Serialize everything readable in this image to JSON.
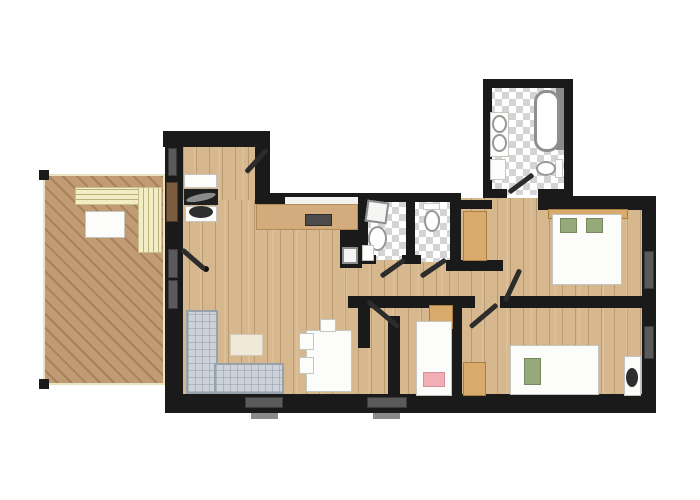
{
  "plan": {
    "width": 700,
    "height": 500
  },
  "palette": {
    "wall": "#1a1a1a",
    "interior_wood": "#d7b88e",
    "deck_wood": "#b9926b",
    "tile_gray": "#d4d4d4",
    "sofa_gray": "#ccd2d9",
    "bench_cream": "#f2ecc4",
    "cabinet_tan": "#d8aa6c",
    "pillow_green": "#95a97b",
    "pillow_pink": "#f3adb5",
    "fixture_white": "#fcfcfb",
    "window_gray": "#5a5a5a"
  },
  "elements": [
    {
      "name": "deck-terrace-floor",
      "type": "deck",
      "x": 43,
      "y": 174,
      "w": 122,
      "h": 211
    },
    {
      "name": "deck-post-top-left",
      "type": "wall",
      "x": 39,
      "y": 170,
      "w": 10,
      "h": 10
    },
    {
      "name": "deck-post-bottom-left",
      "type": "wall",
      "x": 39,
      "y": 379,
      "w": 10,
      "h": 10
    },
    {
      "name": "floor-entry-hall",
      "type": "wood",
      "x": 170,
      "y": 140,
      "w": 100,
      "h": 120
    },
    {
      "name": "floor-living-room",
      "type": "wood",
      "x": 176,
      "y": 200,
      "w": 222,
      "h": 200
    },
    {
      "name": "floor-corridor",
      "type": "wood",
      "x": 345,
      "y": 255,
      "w": 165,
      "h": 45
    },
    {
      "name": "floor-master-bedroom",
      "type": "wood",
      "x": 458,
      "y": 198,
      "w": 190,
      "h": 105
    },
    {
      "name": "floor-kids-room",
      "type": "wood",
      "x": 395,
      "y": 300,
      "w": 62,
      "h": 98
    },
    {
      "name": "floor-second-bedroom",
      "type": "wood",
      "x": 458,
      "y": 300,
      "w": 190,
      "h": 100
    },
    {
      "name": "floor-bathroom",
      "type": "tile",
      "x": 488,
      "y": 85,
      "w": 80,
      "h": 110
    },
    {
      "name": "floor-wc-laundry",
      "type": "tile",
      "x": 364,
      "y": 200,
      "w": 44,
      "h": 60
    },
    {
      "name": "floor-wc",
      "type": "tile",
      "x": 412,
      "y": 202,
      "w": 40,
      "h": 60
    },
    {
      "name": "wall-entry-top",
      "type": "wall",
      "x": 163,
      "y": 131,
      "w": 107,
      "h": 16
    },
    {
      "name": "wall-entry-left",
      "type": "wall",
      "x": 165,
      "y": 131,
      "w": 18,
      "h": 116
    },
    {
      "name": "wall-entry-right",
      "type": "wall",
      "x": 255,
      "y": 144,
      "w": 15,
      "h": 56
    },
    {
      "name": "wall-kitchen-top",
      "type": "wall",
      "x": 255,
      "y": 193,
      "w": 113,
      "h": 11
    },
    {
      "name": "wall-wc1-left",
      "type": "wall",
      "x": 358,
      "y": 193,
      "w": 10,
      "h": 70
    },
    {
      "name": "wall-wc-top",
      "type": "wall",
      "x": 362,
      "y": 193,
      "w": 99,
      "h": 9
    },
    {
      "name": "wall-wc-divider",
      "type": "wall",
      "x": 406,
      "y": 196,
      "w": 9,
      "h": 64
    },
    {
      "name": "wall-wc2-right",
      "type": "wall",
      "x": 450,
      "y": 196,
      "w": 11,
      "h": 72
    },
    {
      "name": "wall-wc1-bottom-stub",
      "type": "wall",
      "x": 358,
      "y": 255,
      "w": 18,
      "h": 9
    },
    {
      "name": "wall-wc2-bottom-stub",
      "type": "wall",
      "x": 402,
      "y": 255,
      "w": 19,
      "h": 9
    },
    {
      "name": "wall-vestibule-top",
      "type": "wall",
      "x": 450,
      "y": 200,
      "w": 42,
      "h": 9
    },
    {
      "name": "wall-bathroom-left",
      "type": "wall",
      "x": 483,
      "y": 79,
      "w": 9,
      "h": 119
    },
    {
      "name": "wall-bathroom-top",
      "type": "wall",
      "x": 483,
      "y": 79,
      "w": 90,
      "h": 9
    },
    {
      "name": "wall-bathroom-right",
      "type": "wall",
      "x": 564,
      "y": 79,
      "w": 9,
      "h": 119
    },
    {
      "name": "wall-bathroom-bottom-left",
      "type": "wall",
      "x": 483,
      "y": 189,
      "w": 24,
      "h": 9
    },
    {
      "name": "wall-bathroom-bottom-right",
      "type": "wall",
      "x": 538,
      "y": 189,
      "w": 35,
      "h": 9
    },
    {
      "name": "wall-right-wing-top",
      "type": "wall",
      "x": 538,
      "y": 196,
      "w": 118,
      "h": 14
    },
    {
      "name": "wall-exterior-right",
      "type": "wall",
      "x": 642,
      "y": 196,
      "w": 14,
      "h": 217
    },
    {
      "name": "wall-exterior-bottom",
      "type": "wall",
      "x": 165,
      "y": 394,
      "w": 491,
      "h": 19
    },
    {
      "name": "wall-living-left",
      "type": "wall",
      "x": 165,
      "y": 243,
      "w": 18,
      "h": 155
    },
    {
      "name": "wall-corridor-south-a",
      "type": "wall",
      "x": 348,
      "y": 296,
      "w": 127,
      "h": 12
    },
    {
      "name": "wall-corridor-south-b",
      "type": "wall",
      "x": 500,
      "y": 296,
      "w": 142,
      "h": 12
    },
    {
      "name": "wall-kids-left-stub",
      "type": "wall",
      "x": 358,
      "y": 296,
      "w": 12,
      "h": 52
    },
    {
      "name": "wall-kids-left",
      "type": "wall",
      "x": 388,
      "y": 316,
      "w": 12,
      "h": 80
    },
    {
      "name": "wall-kids-right",
      "type": "wall",
      "x": 452,
      "y": 296,
      "w": 10,
      "h": 100
    },
    {
      "name": "wall-master-entry-stub",
      "type": "wall",
      "x": 446,
      "y": 260,
      "w": 57,
      "h": 11
    },
    {
      "name": "kitchen-wall-block",
      "type": "wall",
      "x": 340,
      "y": 228,
      "w": 22,
      "h": 40
    },
    {
      "name": "window-entry-left",
      "type": "window",
      "x": 168,
      "y": 148,
      "w": 9,
      "h": 28
    },
    {
      "name": "deck-access-door",
      "type": "brown-door",
      "x": 166,
      "y": 182,
      "w": 12,
      "h": 40
    },
    {
      "name": "sliding-door-living-left-top",
      "type": "window",
      "x": 168,
      "y": 249,
      "w": 10,
      "h": 29
    },
    {
      "name": "sliding-door-living-left-bottom",
      "type": "window",
      "x": 168,
      "y": 280,
      "w": 10,
      "h": 29
    },
    {
      "name": "window-right-1",
      "type": "window",
      "x": 644,
      "y": 251,
      "w": 10,
      "h": 38
    },
    {
      "name": "window-right-2",
      "type": "window",
      "x": 644,
      "y": 326,
      "w": 10,
      "h": 33
    },
    {
      "name": "window-bottom-1",
      "type": "window",
      "x": 245,
      "y": 397,
      "w": 38,
      "h": 11
    },
    {
      "name": "window-bottom-2",
      "type": "window",
      "x": 367,
      "y": 397,
      "w": 40,
      "h": 11
    },
    {
      "name": "window-sill-bottom-1",
      "type": "sill",
      "x": 251,
      "y": 413,
      "w": 27,
      "h": 6
    },
    {
      "name": "window-sill-bottom-2",
      "type": "sill",
      "x": 373,
      "y": 413,
      "w": 27,
      "h": 6
    },
    {
      "name": "kitchen-backsplash",
      "type": "backsplash",
      "x": 285,
      "y": 197,
      "w": 73,
      "h": 7
    },
    {
      "name": "deck-bench-horizontal",
      "type": "bench-h",
      "x": 75,
      "y": 187,
      "w": 66,
      "h": 18
    },
    {
      "name": "deck-bench-vertical",
      "type": "bench-v",
      "x": 138,
      "y": 187,
      "w": 24,
      "h": 66
    },
    {
      "name": "deck-table",
      "type": "white-f",
      "x": 85,
      "y": 211,
      "w": 40,
      "h": 27
    },
    {
      "name": "entry-closet-upper",
      "type": "white-f",
      "x": 184,
      "y": 174,
      "w": 33,
      "h": 14
    },
    {
      "name": "entry-console",
      "type": "dark",
      "x": 184,
      "y": 189,
      "w": 34,
      "h": 16
    },
    {
      "name": "entry-console-blade",
      "type": "blade",
      "x": 186,
      "y": 194,
      "w": 30,
      "h": 7,
      "rot": -12
    },
    {
      "name": "entry-closet-lower",
      "type": "white-f",
      "x": 185,
      "y": 206,
      "w": 32,
      "h": 16
    },
    {
      "name": "entry-bench-blob",
      "type": "blob",
      "x": 189,
      "y": 206,
      "w": 24,
      "h": 12
    },
    {
      "name": "kitchen-counter",
      "type": "counter",
      "x": 256,
      "y": 204,
      "w": 102,
      "h": 26
    },
    {
      "name": "kitchen-cooktop",
      "type": "cooktop",
      "x": 305,
      "y": 214,
      "w": 27,
      "h": 12
    },
    {
      "name": "kitchen-sink-unit",
      "type": "appliance",
      "x": 342,
      "y": 247,
      "w": 16,
      "h": 17
    },
    {
      "name": "sofa-corner-vertical",
      "type": "sofa",
      "x": 186,
      "y": 310,
      "w": 32,
      "h": 84
    },
    {
      "name": "sofa-corner-horizontal",
      "type": "sofa",
      "x": 214,
      "y": 363,
      "w": 70,
      "h": 31
    },
    {
      "name": "coffee-table",
      "type": "cream",
      "x": 230,
      "y": 334,
      "w": 33,
      "h": 22
    },
    {
      "name": "dining-table",
      "type": "white-f",
      "x": 306,
      "y": 330,
      "w": 46,
      "h": 62
    },
    {
      "name": "dining-chair-1",
      "type": "white-f",
      "x": 299,
      "y": 333,
      "w": 15,
      "h": 17
    },
    {
      "name": "dining-chair-2",
      "type": "white-f",
      "x": 299,
      "y": 357,
      "w": 15,
      "h": 17
    },
    {
      "name": "dining-chair-3",
      "type": "white-f",
      "x": 320,
      "y": 319,
      "w": 16,
      "h": 13
    },
    {
      "name": "master-wardrobe",
      "type": "tan",
      "x": 463,
      "y": 211,
      "w": 24,
      "h": 50
    },
    {
      "name": "master-bed-headboard",
      "type": "tan",
      "x": 548,
      "y": 209,
      "w": 80,
      "h": 10
    },
    {
      "name": "master-double-bed",
      "type": "white-f",
      "x": 552,
      "y": 214,
      "w": 70,
      "h": 71
    },
    {
      "name": "master-pillow-left",
      "type": "green",
      "x": 560,
      "y": 218,
      "w": 17,
      "h": 15
    },
    {
      "name": "master-pillow-right",
      "type": "green",
      "x": 586,
      "y": 218,
      "w": 17,
      "h": 15
    },
    {
      "name": "kids-cabinet",
      "type": "tan",
      "x": 429,
      "y": 305,
      "w": 24,
      "h": 24
    },
    {
      "name": "kids-bed",
      "type": "white-f",
      "x": 416,
      "y": 321,
      "w": 36,
      "h": 75
    },
    {
      "name": "kids-pillow-pink",
      "type": "pink",
      "x": 423,
      "y": 372,
      "w": 22,
      "h": 15
    },
    {
      "name": "bedroom2-cabinet",
      "type": "tan",
      "x": 463,
      "y": 362,
      "w": 23,
      "h": 34
    },
    {
      "name": "bedroom2-bed",
      "type": "white-f",
      "x": 510,
      "y": 345,
      "w": 89,
      "h": 50
    },
    {
      "name": "bedroom2-pillow-green",
      "type": "green",
      "x": 524,
      "y": 358,
      "w": 17,
      "h": 27
    },
    {
      "name": "bedroom2-desk",
      "type": "white-f",
      "x": 624,
      "y": 356,
      "w": 17,
      "h": 40
    },
    {
      "name": "bedroom2-chair-blob",
      "type": "blob",
      "x": 626,
      "y": 368,
      "w": 12,
      "h": 19
    },
    {
      "name": "washing-machine",
      "type": "appliance",
      "x": 366,
      "y": 201,
      "w": 22,
      "h": 22,
      "rot": 8
    },
    {
      "name": "wc1-toilet",
      "type": "basin",
      "x": 368,
      "y": 226,
      "w": 19,
      "h": 25
    },
    {
      "name": "wc1-shelf",
      "type": "white-f",
      "x": 362,
      "y": 245,
      "w": 12,
      "h": 16
    },
    {
      "name": "wc2-cistern",
      "type": "white-f",
      "x": 423,
      "y": 203,
      "w": 17,
      "h": 7
    },
    {
      "name": "wc2-toilet",
      "type": "basin",
      "x": 424,
      "y": 210,
      "w": 16,
      "h": 22
    },
    {
      "name": "bathtub-ledge",
      "type": "sill",
      "x": 556,
      "y": 88,
      "w": 8,
      "h": 62
    },
    {
      "name": "bathtub",
      "type": "tub",
      "x": 534,
      "y": 90,
      "w": 26,
      "h": 62
    },
    {
      "name": "bathroom-vanity",
      "type": "white-f",
      "x": 490,
      "y": 112,
      "w": 19,
      "h": 45
    },
    {
      "name": "bathroom-basin-1",
      "type": "basin",
      "x": 492,
      "y": 115,
      "w": 15,
      "h": 18
    },
    {
      "name": "bathroom-basin-2",
      "type": "basin",
      "x": 492,
      "y": 134,
      "w": 15,
      "h": 18
    },
    {
      "name": "bathroom-cabinet",
      "type": "white-f",
      "x": 490,
      "y": 159,
      "w": 16,
      "h": 21
    },
    {
      "name": "bathroom-toilet-cistern",
      "type": "white-f",
      "x": 555,
      "y": 159,
      "w": 8,
      "h": 19
    },
    {
      "name": "bathroom-toilet",
      "type": "basin",
      "x": 536,
      "y": 161,
      "w": 20,
      "h": 15
    },
    {
      "name": "deck-door-hinge-dot",
      "type": "dot",
      "x": 203,
      "y": 266,
      "w": 6,
      "h": 6
    }
  ],
  "doors": [
    {
      "name": "door-leaf-entry",
      "x1": 267,
      "y1": 149,
      "x2": 246,
      "y2": 172
    },
    {
      "name": "door-leaf-deck",
      "x1": 182,
      "y1": 249,
      "x2": 205,
      "y2": 269
    },
    {
      "name": "door-leaf-wc1",
      "x1": 381,
      "y1": 276,
      "x2": 405,
      "y2": 259
    },
    {
      "name": "door-leaf-wc2",
      "x1": 421,
      "y1": 276,
      "x2": 446,
      "y2": 259
    },
    {
      "name": "door-leaf-master",
      "x1": 520,
      "y1": 269,
      "x2": 505,
      "y2": 301
    },
    {
      "name": "door-leaf-kids",
      "x1": 368,
      "y1": 301,
      "x2": 399,
      "y2": 327
    },
    {
      "name": "door-leaf-bedroom2",
      "x1": 497,
      "y1": 304,
      "x2": 470,
      "y2": 327
    },
    {
      "name": "door-leaf-bathroom",
      "x1": 509,
      "y1": 192,
      "x2": 533,
      "y2": 174
    }
  ]
}
